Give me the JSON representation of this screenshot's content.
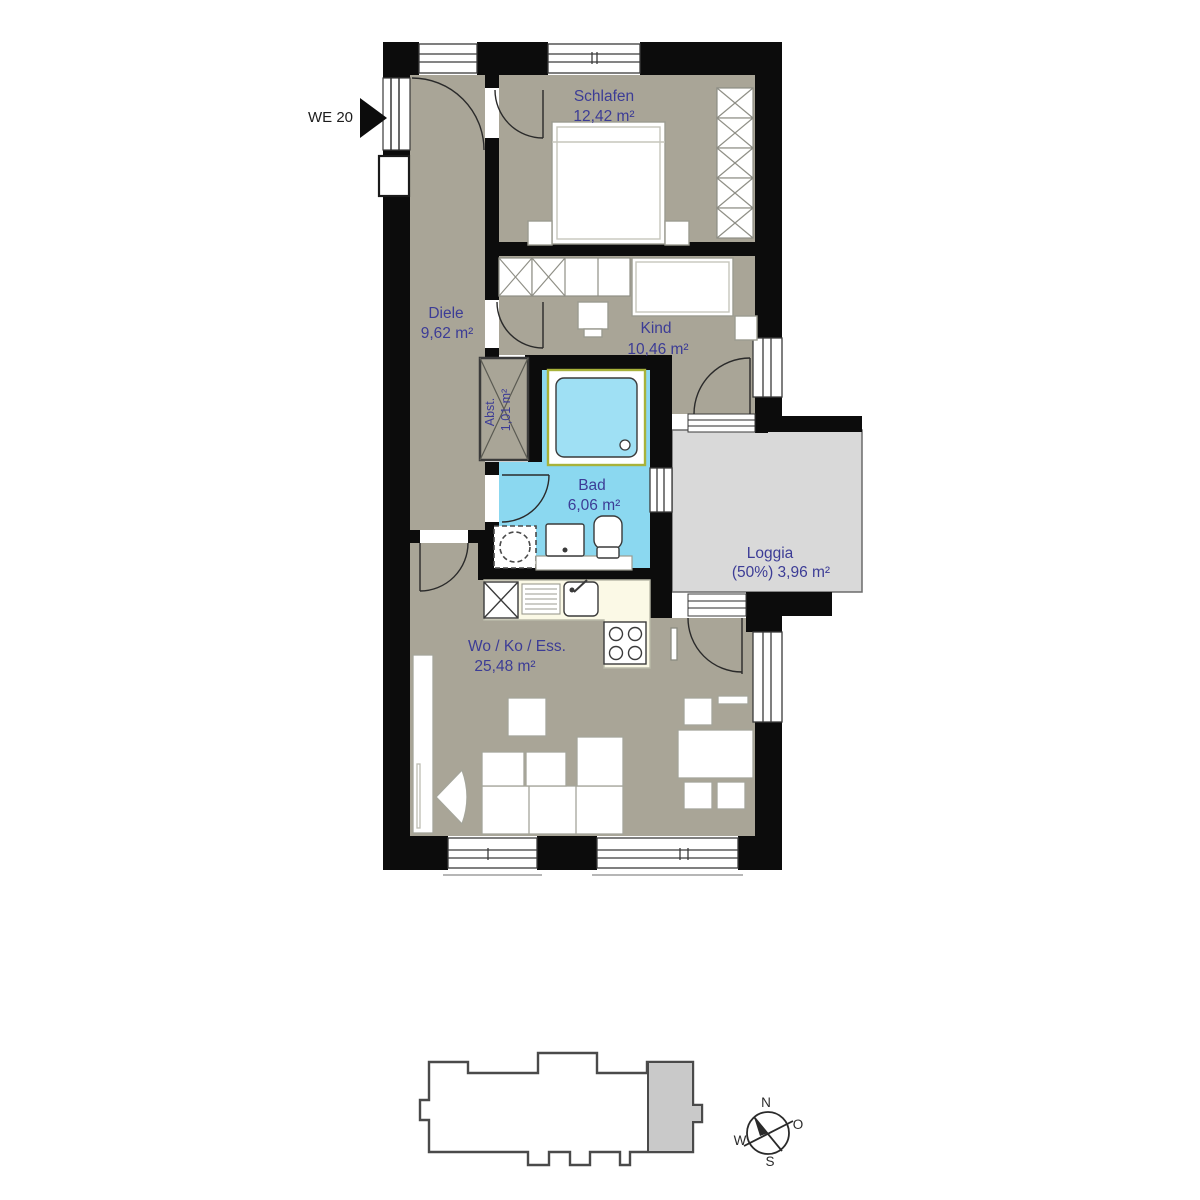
{
  "unit": {
    "label": "WE 20"
  },
  "rooms": {
    "schlafen": {
      "name": "Schlafen",
      "area": "12,42 m²"
    },
    "diele": {
      "name": "Diele",
      "area": "9,62 m²"
    },
    "kind": {
      "name": "Kind",
      "area": "10,46 m²"
    },
    "abst": {
      "name": "Abst.",
      "area": "1,01 m²"
    },
    "bad": {
      "name": "Bad",
      "area": "6,06 m²"
    },
    "loggia": {
      "name": "Loggia",
      "area": "(50%) 3,96 m²"
    },
    "wohnen": {
      "name": "Wo / Ko / Ess.",
      "area": "25,48 m²"
    }
  },
  "compass": {
    "north": "N",
    "east": "O",
    "south": "S",
    "west": "W"
  },
  "colors": {
    "wall": "#0c0c0c",
    "floor": "#a9a597",
    "bath_floor": "#8bd8f0",
    "loggia_floor": "#d9d9d9",
    "label_blue": "#3c3c96",
    "kitchen_counter": "#fbf9e6",
    "tub_accent": "#a8b23a",
    "keyplan_highlight": "#c9c9c9"
  }
}
